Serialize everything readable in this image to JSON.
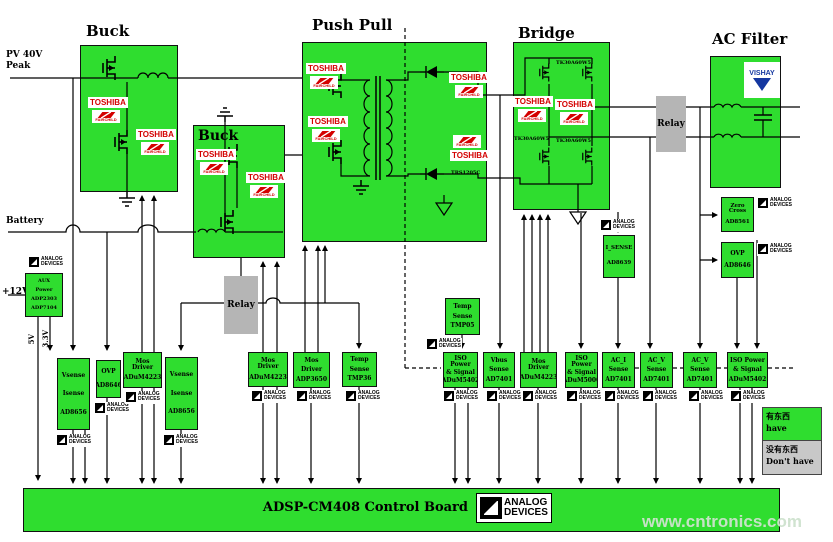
{
  "sections": {
    "buck1": {
      "title": "Buck"
    },
    "buck2": {
      "title": "Buck"
    },
    "pushpull": {
      "title": "Push Pull"
    },
    "bridge": {
      "title": "Bridge"
    },
    "acfilter": {
      "title": "AC Filter"
    }
  },
  "io_labels": {
    "pv_line1": "PV 40V",
    "pv_line2": "Peak",
    "battery": "Battery",
    "v12": "+12V",
    "rail_5v": "5V",
    "rail_3v3": "3.3V"
  },
  "relays": {
    "relay1": "Relay",
    "relay2": "Relay"
  },
  "brands": {
    "toshiba": "TOSHIBA",
    "fairchild": "FAIRCHILD",
    "vishay": "VISHAY",
    "adi_l1": "ANALOG",
    "adi_l2": "DEVICES"
  },
  "part_labels": {
    "bridge_fet": "TK30A60W5",
    "pp_diode": "TRS1205C"
  },
  "aux_box": {
    "l1": "AUX",
    "l2": "Power",
    "l3": "ADP2303",
    "l4": "ADP7104"
  },
  "boxes": [
    {
      "l1": "Vsense",
      "l2": "Isense",
      "l3": "AD8656"
    },
    {
      "l1": "OVP",
      "l2": "AD8646"
    },
    {
      "l1": "Mos Driver",
      "l2": "ADuM4223"
    },
    {
      "l1": "Vsense",
      "l2": "Isense",
      "l3": "AD8656"
    },
    {
      "l1": "Mos Driver",
      "l2": "ADuM4223"
    },
    {
      "l1": "Mos",
      "l2": "Driver",
      "l3": "ADP3650"
    },
    {
      "l1": "Temp",
      "l2": "Sense",
      "l3": "TMP36"
    },
    {
      "l1": "Temp",
      "l2": "Sense",
      "l3": "TMP05"
    },
    {
      "l1": "ISO Power",
      "l2": "& Signal",
      "l3": "ADuM5402"
    },
    {
      "l1": "Vbus",
      "l2": "Sense",
      "l3": "AD7401"
    },
    {
      "l1": "Mos Driver",
      "l2": "ADuM4223"
    },
    {
      "l1": "ISO Power",
      "l2": "& Signal",
      "l3": "ADuM5000"
    },
    {
      "l1": "AC_I",
      "l2": "Sense",
      "l3": "AD7401"
    },
    {
      "l1": "AC_V",
      "l2": "Sense",
      "l3": "AD7401"
    },
    {
      "l1": "AC_V",
      "l2": "Sense",
      "l3": "AD7401"
    },
    {
      "l1": "ISO Power",
      "l2": "& Signal",
      "l3": "ADuM5402"
    },
    {
      "l1": "I_SENSE",
      "l2": "AD8639"
    },
    {
      "l1": "Zero Cross",
      "l2": "AD8561"
    },
    {
      "l1": "OVP",
      "l2": "AD8646"
    }
  ],
  "board": {
    "title": "ADSP-CM408 Control Board"
  },
  "legend": {
    "have_cn": "有东西",
    "have_en": "have",
    "none_cn": "没有东西",
    "none_en": "Don't have"
  },
  "watermark": "www.cntronics.com"
}
